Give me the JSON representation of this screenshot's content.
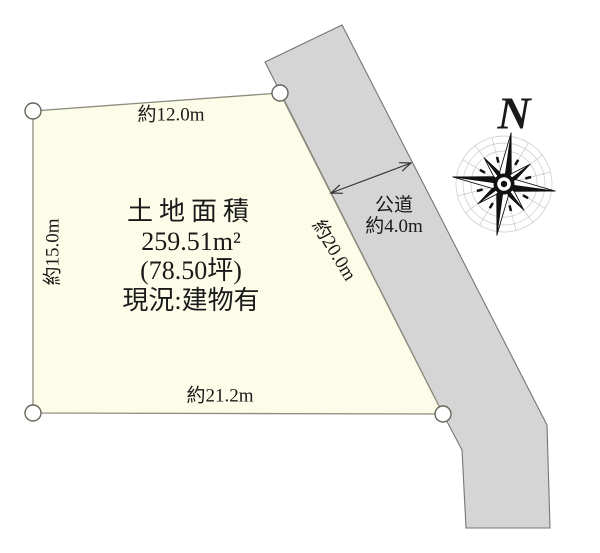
{
  "colors": {
    "plot_fill": "#fcfce8",
    "plot_stroke": "#8c8c7e",
    "road_fill": "#d5d5d5",
    "road_stroke": "#757575",
    "text": "#1a1a1a",
    "compass_web": "#c9c9c9"
  },
  "plot": {
    "label_line1": "土地面積",
    "label_line2": "259.51m²",
    "label_line3": "(78.50坪)",
    "label_line4": "現況:建物有",
    "dim_top": "約12.0m",
    "dim_left": "約15.0m",
    "dim_right": "約20.0m",
    "dim_bottom": "約21.2m"
  },
  "road": {
    "label_line1": "公道",
    "label_line2": "約4.0m"
  },
  "compass": {
    "north": "N"
  }
}
